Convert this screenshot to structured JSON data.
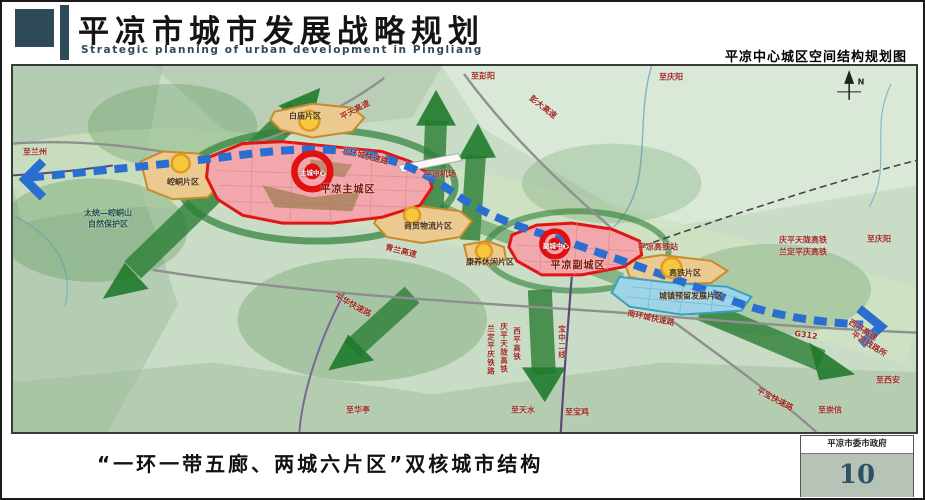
{
  "header": {
    "title": "平凉市城市发展战略规划",
    "subtitle_en": "Strategic planning of urban development in Pingliang",
    "map_title": "平凉中心城区空间结构规划图"
  },
  "footer": {
    "caption": "“一环一带五廊、两城六片区”双核城市结构",
    "org": "平凉市委市政府",
    "page": "10"
  },
  "colors": {
    "accent_slate": "#2e4a58",
    "zone_red_stroke": "#e01616",
    "zone_red_fill": "#f2a7ad",
    "zone_orange_stroke": "#c98a2a",
    "zone_orange_fill": "#ecc98f",
    "zone_blue_fill": "#9fd4e6",
    "corridor_green": "#2e8038",
    "belt_blue": "#2a6fd0",
    "terrain_green": "#c9dcc6"
  },
  "map": {
    "compass": "N",
    "labels": {
      "to_lanzhou": "至兰州",
      "nature_reserve_1": "太统—崆峒山",
      "nature_reserve_2": "自然保护区",
      "kongtong_district": "崆峒片区",
      "main_city": "平凉主城区",
      "main_center": "主城中心",
      "baimiao_district": "白庙片区",
      "pingtian_hwy": "平天高速",
      "north_ring_rd": "北环城快速路",
      "to_pengyang": "至彭阳",
      "pengda_hwy": "彭大高速",
      "to_qingyang_top": "至庆阳",
      "airport": "平凉机场",
      "qinglan_hwy": "青兰高速",
      "trade_logistics_district": "商贸物流片区",
      "health_leisure_district": "康养休闲片区",
      "sub_center": "副城中心",
      "sub_city": "平凉副城区",
      "hsr_station": "平凉高铁站",
      "hsr_district": "高铁片区",
      "reserved_dev_district": "城镇预留发展片区",
      "qptl_hsr": "庆平天陇高铁",
      "ldpq_hsr": "兰定平庆高铁",
      "to_qingyang_right": "至庆阳",
      "south_ring_rd": "南环城快速路",
      "g312": "G312",
      "xiping_hwy": "西平高速",
      "pl_junction": "平凉线路所",
      "pingbao_rd": "平宝快速路",
      "to_chongxin": "至崇信",
      "to_xian": "至西安",
      "to_huating": "至华亭",
      "to_tianshui": "至天水",
      "to_baoji": "至宝鸡",
      "xiping_rail_v": "西平高铁",
      "qptl_rail_v": "庆平天陇高铁",
      "lanping_rail_v": "兰定平庆铁路",
      "baozhong_line_v": "宝中二线",
      "pinghua_rd": "平华快速路"
    }
  }
}
